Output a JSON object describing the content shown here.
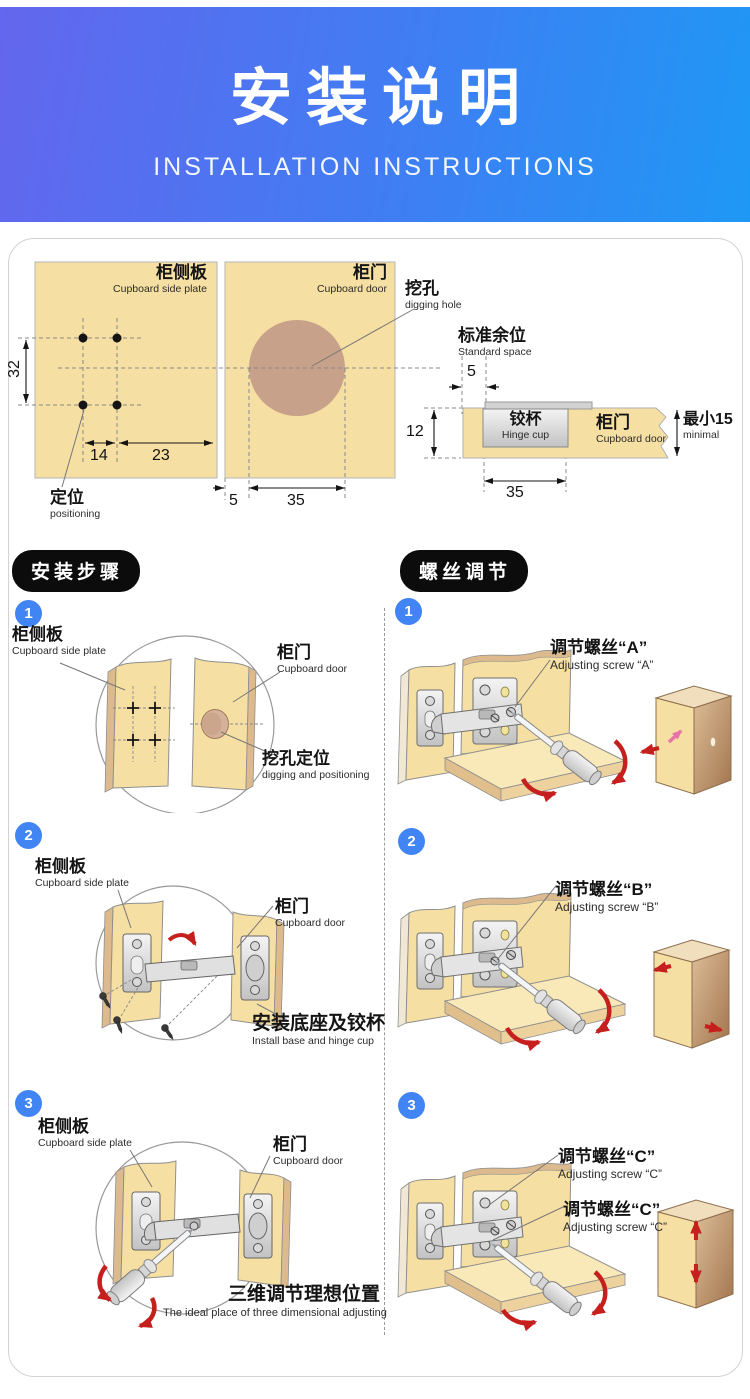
{
  "header": {
    "title": "安装说明",
    "subtitle": "INSTALLATION INSTRUCTIONS"
  },
  "colors": {
    "header_gradient_left": "#6366ee",
    "header_gradient_right": "#1e98f5",
    "wood": "#f6dfa2",
    "hole_brown": "#c7a189",
    "step_badge_blue": "#4184f3",
    "arrow_red": "#c6201e",
    "pill_black": "#0c0c0c"
  },
  "top_diagram": {
    "side_plate": {
      "label_cn": "柜侧板",
      "label_en": "Cupboard side plate",
      "dim_height": "32",
      "dim_w1": "14",
      "dim_w2": "23",
      "positioning_cn": "定位",
      "positioning_en": "positioning"
    },
    "door": {
      "label_cn": "柜门",
      "label_en": "Cupboard door",
      "digging_cn": "挖孔",
      "digging_en": "digging hole",
      "dim_edge": "5",
      "dim_hole": "35"
    },
    "cross_section": {
      "standard_cn": "标准余位",
      "standard_en": "Standard space",
      "dim_space": "5",
      "dim_thick": "12",
      "cup_cn": "铰杯",
      "cup_en": "Hinge cup",
      "door_cn": "柜门",
      "door_en": "Cupboard door",
      "min_cn": "最小15",
      "min_en": "minimal",
      "dim_cup": "35"
    }
  },
  "install": {
    "title": "安装步骤",
    "steps": [
      {
        "num": "1",
        "side_cn": "柜侧板",
        "side_en": "Cupboard side plate",
        "door_cn": "柜门",
        "door_en": "Cupboard door",
        "note_cn": "挖孔定位",
        "note_en": "digging and positioning"
      },
      {
        "num": "2",
        "side_cn": "柜侧板",
        "side_en": "Cupboard side plate",
        "door_cn": "柜门",
        "door_en": "Cupboard door",
        "note_cn": "安装底座及铰杯",
        "note_en": "Install base and hinge cup"
      },
      {
        "num": "3",
        "side_cn": "柜侧板",
        "side_en": "Cupboard side plate",
        "door_cn": "柜门",
        "door_en": "Cupboard door",
        "note_cn": "三维调节理想位置",
        "note_en": "The ideal place of three dimensional adjusting"
      }
    ]
  },
  "adjust": {
    "title": "螺丝调节",
    "steps": [
      {
        "num": "1",
        "label_cn": "调节螺丝“A”",
        "label_en": "Adjusting screw “A”"
      },
      {
        "num": "2",
        "label_cn": "调节螺丝“B”",
        "label_en": "Adjusting screw “B”"
      },
      {
        "num": "3",
        "label1_cn": "调节螺丝“C”",
        "label1_en": "Adjusting screw “C”",
        "label2_cn": "调节螺丝“C”",
        "label2_en": "Adjusting screw “C”"
      }
    ]
  }
}
